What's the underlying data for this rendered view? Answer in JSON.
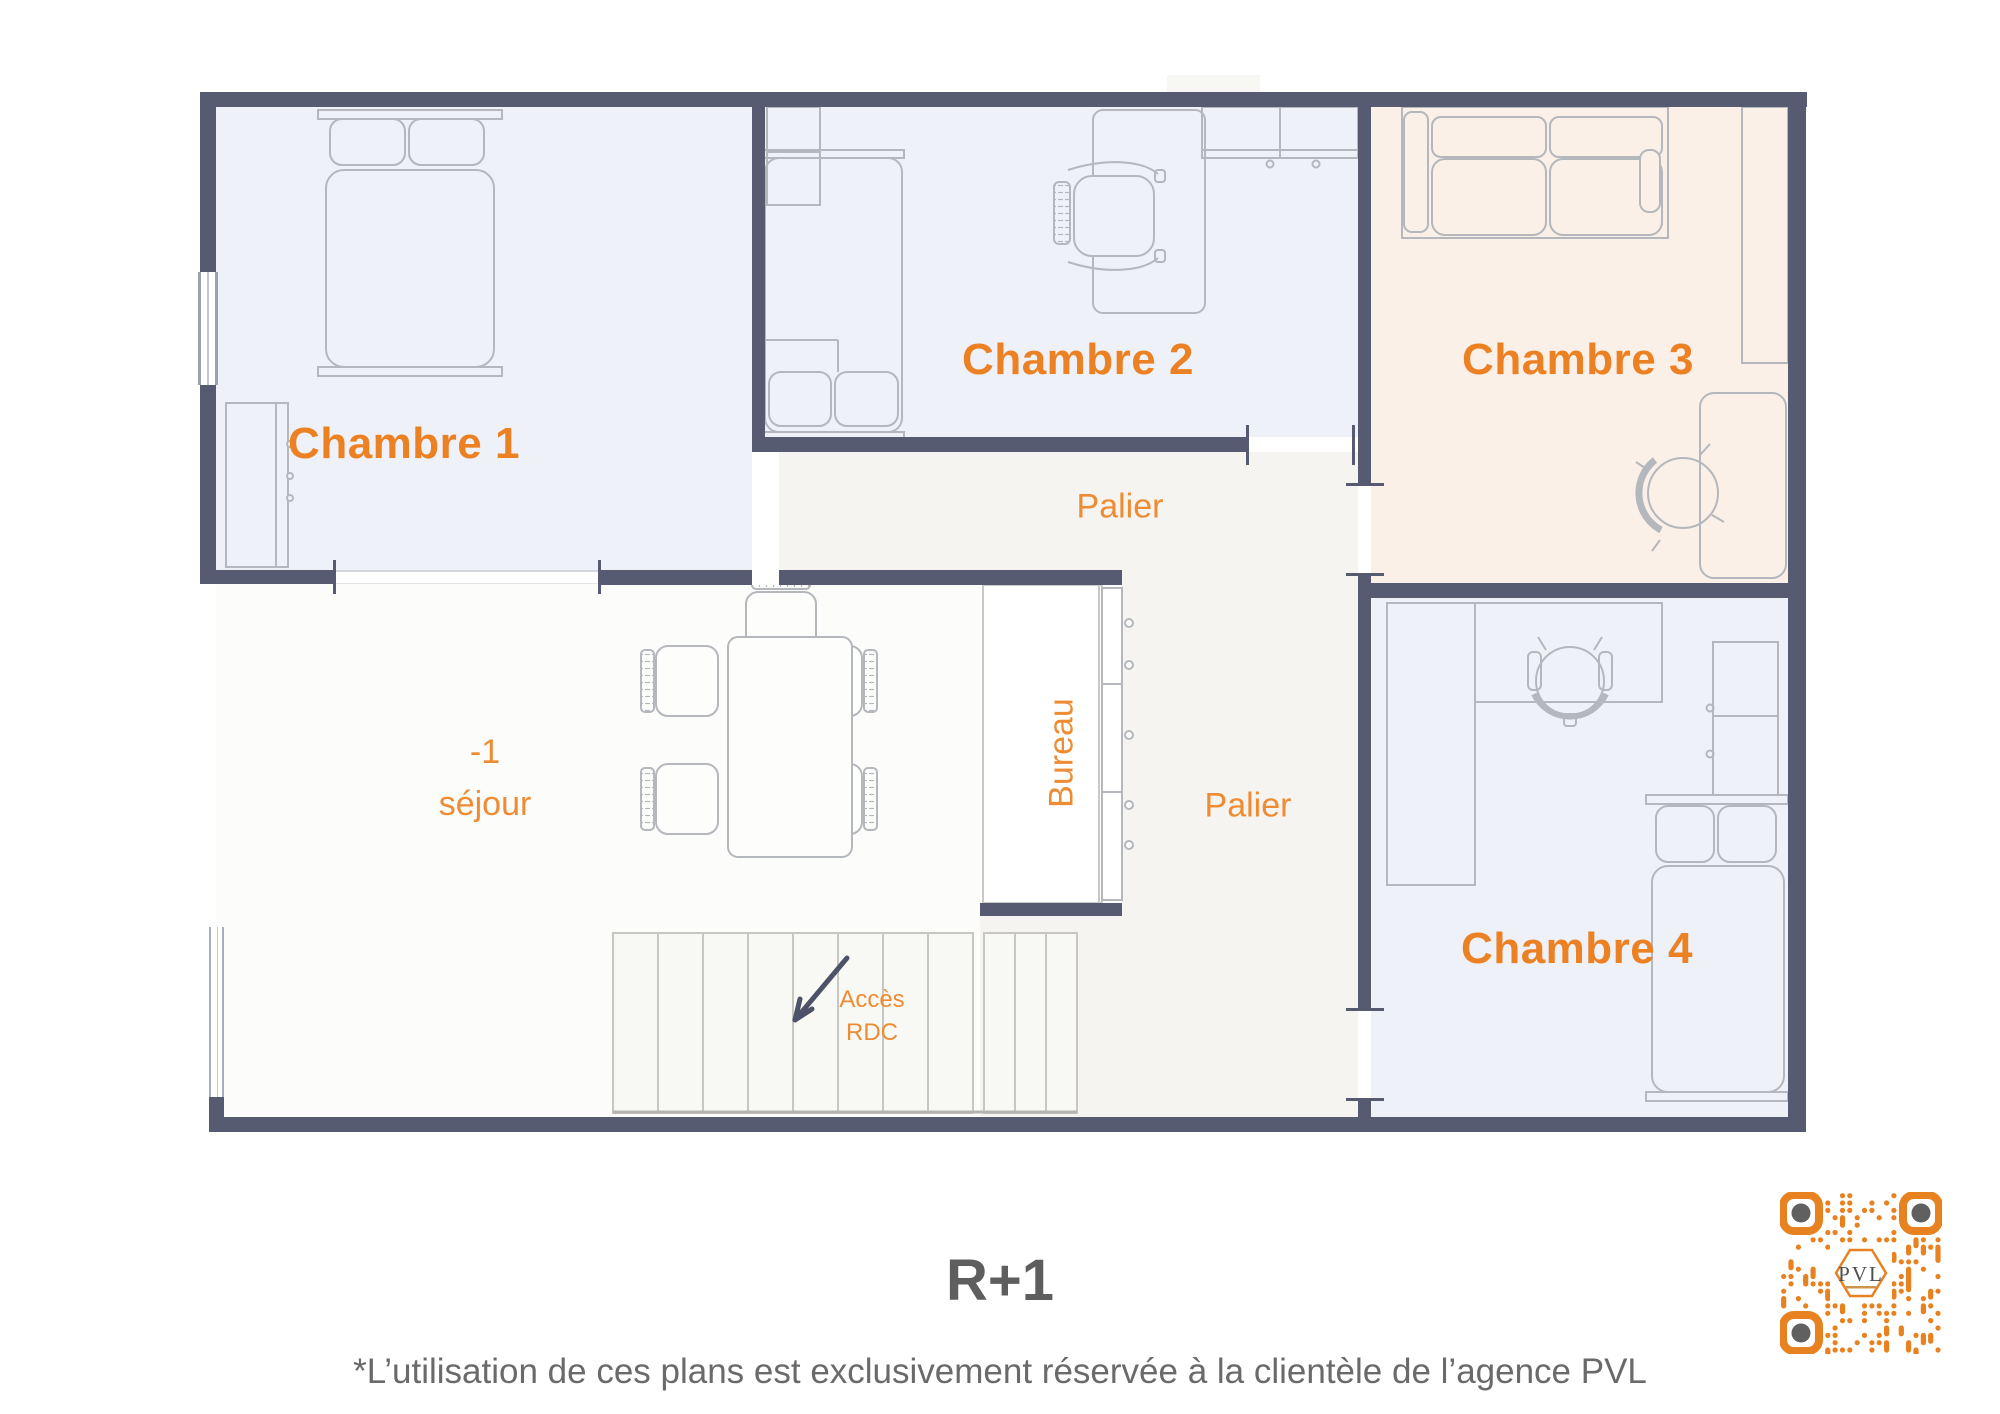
{
  "rooms": [
    {
      "id": "chambre1",
      "label": "Chambre 1"
    },
    {
      "id": "chambre2",
      "label": "Chambre 2"
    },
    {
      "id": "chambre3",
      "label": "Chambre 3"
    },
    {
      "id": "chambre4",
      "label": "Chambre 4"
    }
  ],
  "areas": {
    "palier_top": "Palier",
    "palier_right": "Palier",
    "bureau": "Bureau",
    "sejour": {
      "line1": "-1",
      "line2": "séjour"
    },
    "stairs": {
      "line1": "Accès",
      "line2": "RDC"
    }
  },
  "floor_title": "R+1",
  "disclaimer": "*L’utilisation de ces plans est exclusivement réservée à la clientèle de l’agence PVL",
  "qr": {
    "logo": "PVL"
  },
  "colors": {
    "wall": "#575b72",
    "accent": "#ec8124",
    "accent_light": "#ee8c34",
    "room_blue": "#eef1f8",
    "room_peach": "#faf0e7",
    "corridor": "#f5f4f1",
    "sejour": "#fcfcfa",
    "furniture_stroke": "#b4b7bc",
    "stairs_stroke": "#c6c6c3",
    "arrow": "#4d5268",
    "title_gray": "#5e5e5e",
    "footer_gray": "#6a6a6a",
    "qr_orange": "#e8811f"
  }
}
